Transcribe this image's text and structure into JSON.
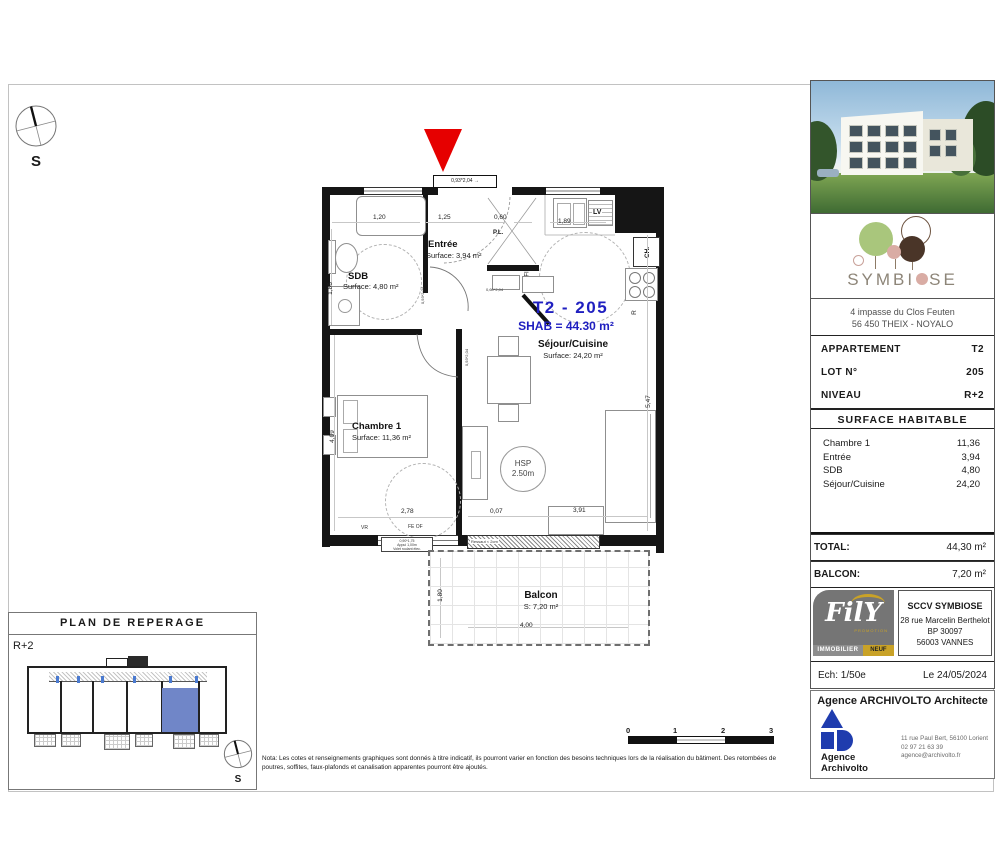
{
  "compass": {
    "label": "S"
  },
  "plan": {
    "title": "T2 - 205",
    "shab": "SHAB = 44.30 m²",
    "rooms": {
      "sdb": {
        "name": "SDB",
        "surface": "Surface: 4,80 m²"
      },
      "entree": {
        "name": "Entrée",
        "surface": "Surface: 3,94 m²"
      },
      "sejour": {
        "name": "Séjour/Cuisine",
        "surface": "Surface: 24,20 m²"
      },
      "chambre": {
        "name": "Chambre 1",
        "surface": "Surface: 11,36 m²"
      },
      "balcon": {
        "name": "Balcon",
        "surface": "S: 7,20 m²"
      }
    },
    "fixtures": {
      "pl": "P.L.",
      "lv": "LV",
      "ch": "CH.",
      "fridge": "R",
      "oven": "FI",
      "hsp_line1": "HSP",
      "hsp_line2": "2.50m"
    },
    "dims": {
      "shower_width": "1,20",
      "entree_width": "1,25",
      "pl_width": "0,60",
      "kitchen_width": "1,89",
      "sdb_height": "1,86",
      "chambre_height": "4,09",
      "chambre_width": "2,78",
      "wall_offset": "0,07",
      "sejour_height": "5,47",
      "sejour_width": "3,91",
      "balcon_height": "1,80",
      "balcon_width": "4,00",
      "entry_door": "0,93*2,04 →",
      "door_sdb": "0,93*2,04",
      "door_chambre": "0,93*2,04",
      "door_pl": "0,60*2,04",
      "vr": "VR",
      "fe_of": "FE OF",
      "ressaut": "Ressaut < 2cm",
      "window_note_1": "0,90*1,75",
      "window_note_2": "Appui 1,00m",
      "window_note_3": "Volet roulant élec."
    }
  },
  "reperage": {
    "title": "PLAN DE REPERAGE",
    "level": "R+2",
    "compass": "S"
  },
  "scalebar": {
    "ticks": [
      "0",
      "1",
      "2",
      "3"
    ]
  },
  "nota": {
    "line1": "Nota: Les cotes et renseignements graphiques sont donnés à titre indicatif, ils pourront varier en fonction des besoins techniques lors de la réalisation du bâtiment. Des retombées de",
    "line2": "poutres, soffites, faux-plafonds et canalisation apparentes pourront être ajoutés."
  },
  "sidebar": {
    "logo_text_left": "SYMBI",
    "logo_text_right": "SE",
    "address_line1": "4 impasse du Clos Feuten",
    "address_line2": "56 450 THEIX - NOYALO",
    "info": [
      {
        "label": "APPARTEMENT",
        "value": "T2"
      },
      {
        "label": "LOT N°",
        "value": "205"
      },
      {
        "label": "NIVEAU",
        "value": "R+2"
      }
    ],
    "surface_header": "SURFACE HABITABLE",
    "rooms": [
      {
        "name": "Chambre 1",
        "value": "11,36"
      },
      {
        "name": "Entrée",
        "value": "3,94"
      },
      {
        "name": "SDB",
        "value": "4,80"
      },
      {
        "name": "Séjour/Cuisine",
        "value": "24,20"
      }
    ],
    "total_label": "TOTAL:",
    "total_value": "44,30 m²",
    "balcon_label": "BALCON:",
    "balcon_value": "7,20 m²",
    "fily": {
      "name": "FilY",
      "sub": "PROMOTION",
      "bar_left": "IMMOBILIER",
      "bar_right": "NEUF"
    },
    "promoter": {
      "name": "SCCV SYMBIOSE",
      "address_line1": "28 rue Marcelin Berthelot",
      "address_line2": "BP 30097",
      "address_line3": "56003 VANNES"
    },
    "scale_label": "Ech: 1/50e",
    "date_label": "Le 24/05/2024",
    "architect": {
      "header": "Agence ARCHIVOLTO Architecte",
      "logo_line1": "Agence",
      "logo_line2": "Archivolto",
      "contact_line1": "11 rue Paul Bert, 56100 Lorient",
      "contact_line2": "02 97 21 63 39",
      "contact_line3": "agence@archivolto.fr"
    }
  },
  "colors": {
    "entrance_marker": "#e60000",
    "plan_title_blue": "#1f1fc0",
    "unit_highlight": "#7086c8",
    "symbiose_green": "#a9c67c",
    "symbiose_brown": "#4a3528",
    "symbiose_pink": "#d9aca4",
    "fily_gold": "#c9a227",
    "archivolto_blue": "#1f3cae"
  }
}
